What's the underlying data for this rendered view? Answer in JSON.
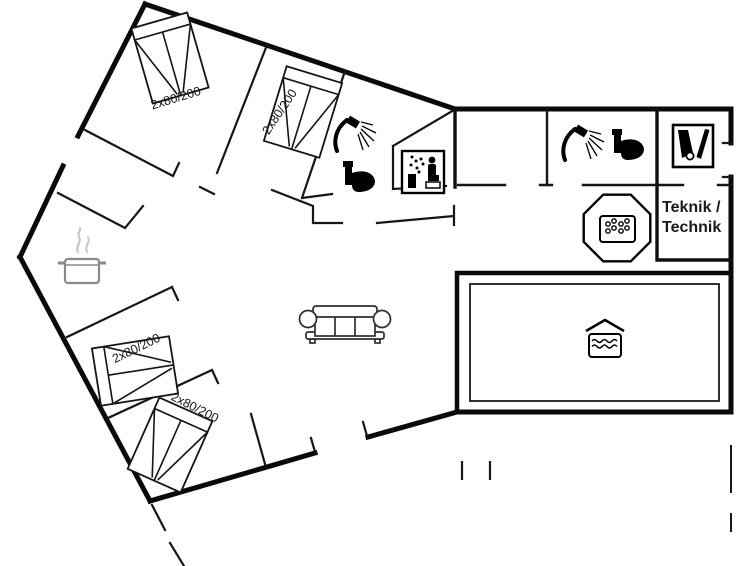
{
  "document": {
    "type": "holiday-home-floor-plan",
    "background": "#ffffff",
    "wall_color": "#0a0a0a",
    "fixture_color": "#000000"
  },
  "beds": [
    {
      "id": "bedroom-1-bed",
      "label": "2x80/200"
    },
    {
      "id": "bedroom-2-bed",
      "label": "2x80/200"
    },
    {
      "id": "bedroom-3-bed",
      "label": "2x80/200"
    },
    {
      "id": "bedroom-4-bed",
      "label": "2x80/200"
    }
  ],
  "rooms": {
    "technical_room": {
      "label_line1": "Teknik /",
      "label_line2": "Technik"
    }
  },
  "icons": [
    "double-bed-icon",
    "shower-icon",
    "toilet-icon",
    "sauna-icon",
    "vacuum-cleaner-icon",
    "whirlpool-icon",
    "swimming-pool-icon",
    "cooking-pot-icon",
    "sofa-icon"
  ]
}
